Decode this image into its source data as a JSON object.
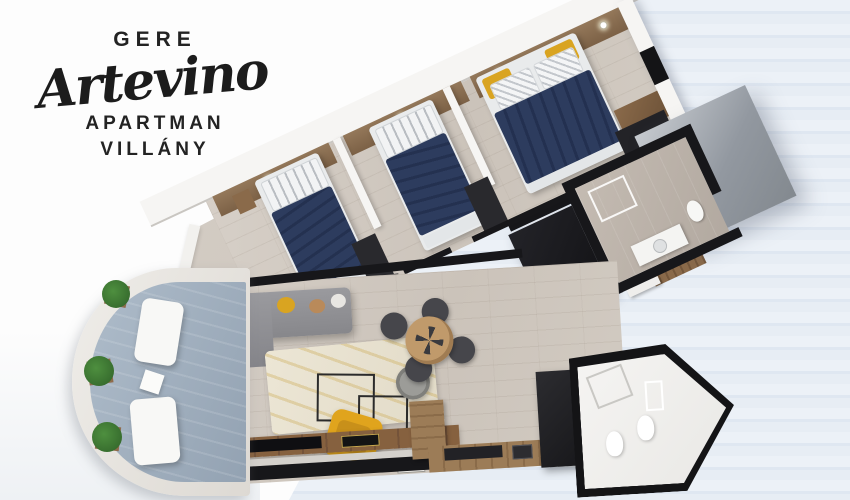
{
  "brand": {
    "name_top": "GERE",
    "name_script": "Artevino",
    "name_mid": "APARTMAN",
    "name_bottom": "VILLÁNY"
  },
  "scene": {
    "type": "3d-top-down-apartment-floor-plan-render",
    "rooms": [
      "bedroom-1",
      "bedroom-2",
      "master-bedroom",
      "bathroom-upper",
      "hallway",
      "living-room",
      "dining-area",
      "kitchen",
      "bathroom-lower",
      "balcony-terrace"
    ],
    "furniture": [
      "single-bed-navy",
      "single-bed-navy",
      "double-bed-navy-yellow-pillows",
      "grey-sofa-with-pillows",
      "hanging-egg-chair",
      "cream-rug",
      "wireframe-coffee-tables",
      "yellow-armchair",
      "tv-sideboard",
      "round-dining-table",
      "four-dark-chairs",
      "l-shaped-kitchen",
      "wardrobe-blocks",
      "toilet",
      "sink-vanity",
      "shower",
      "white-loungers",
      "potted-plants"
    ]
  },
  "palette": {
    "background": "#fdfdfd",
    "deck_stripe_light": "#ecf1f7",
    "deck_stripe_dark": "#dfe7f1",
    "wood_floor": "#cfc8bf",
    "wall_black": "#17171a",
    "wall_white": "#f6f5f3",
    "headboard_wood": "#8a6e50",
    "duvet_navy": "#2d3c5e",
    "pillow_yellow": "#d9a421",
    "sofa_grey": "#90908f",
    "rug_cream": "#eae4d3",
    "armchair_yellow": "#e0a41d",
    "tv_console_wood": "#7c5b3f",
    "kitchen_wood": "#9c7c57",
    "balcony_floor": "#a7b4c2",
    "plant_green": "#3c7a33",
    "roof_panel_grey": "#9aa0a8",
    "bath_tile": "#beb5ac",
    "logo_text": "#232323"
  }
}
